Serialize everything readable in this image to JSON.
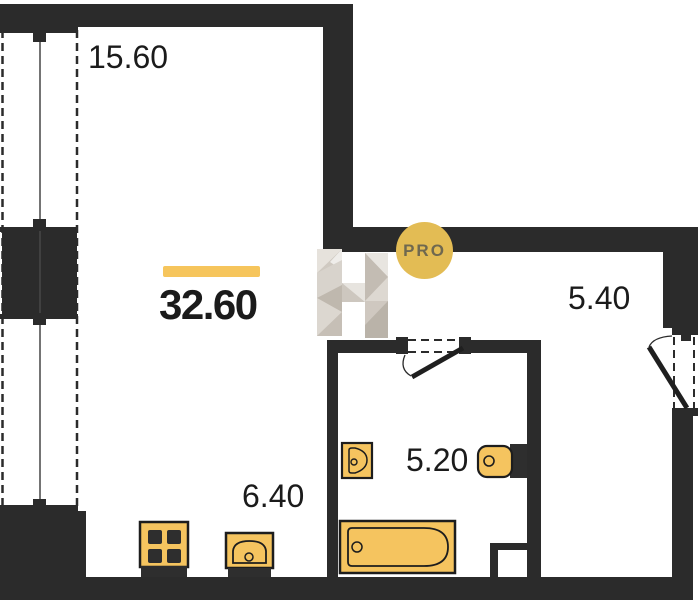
{
  "plan": {
    "watermark_badge": "PRO",
    "total_area": "32.60",
    "rooms": [
      {
        "name": "main-room",
        "area": "15.60"
      },
      {
        "name": "kitchen-zone",
        "area": "6.40"
      },
      {
        "name": "hallway",
        "area": "5.40"
      },
      {
        "name": "bathroom",
        "area": "5.20"
      }
    ],
    "fixtures": [
      "stove",
      "kitchen-sink",
      "bathtub",
      "wash-basin",
      "toilet"
    ],
    "doors": [
      "entrance-door",
      "bathroom-door"
    ],
    "windows": [
      "balcony-glazing"
    ],
    "colors": {
      "wall": "#2B2B2B",
      "accent": "#F6C55C",
      "fixture_fill": "#F5C45F",
      "badge_fill": "#E3BC54",
      "badge_text": "#6F684F",
      "watermark_greys": [
        "#E8E5E0",
        "#D3CDC5",
        "#C0B9AF"
      ]
    }
  }
}
